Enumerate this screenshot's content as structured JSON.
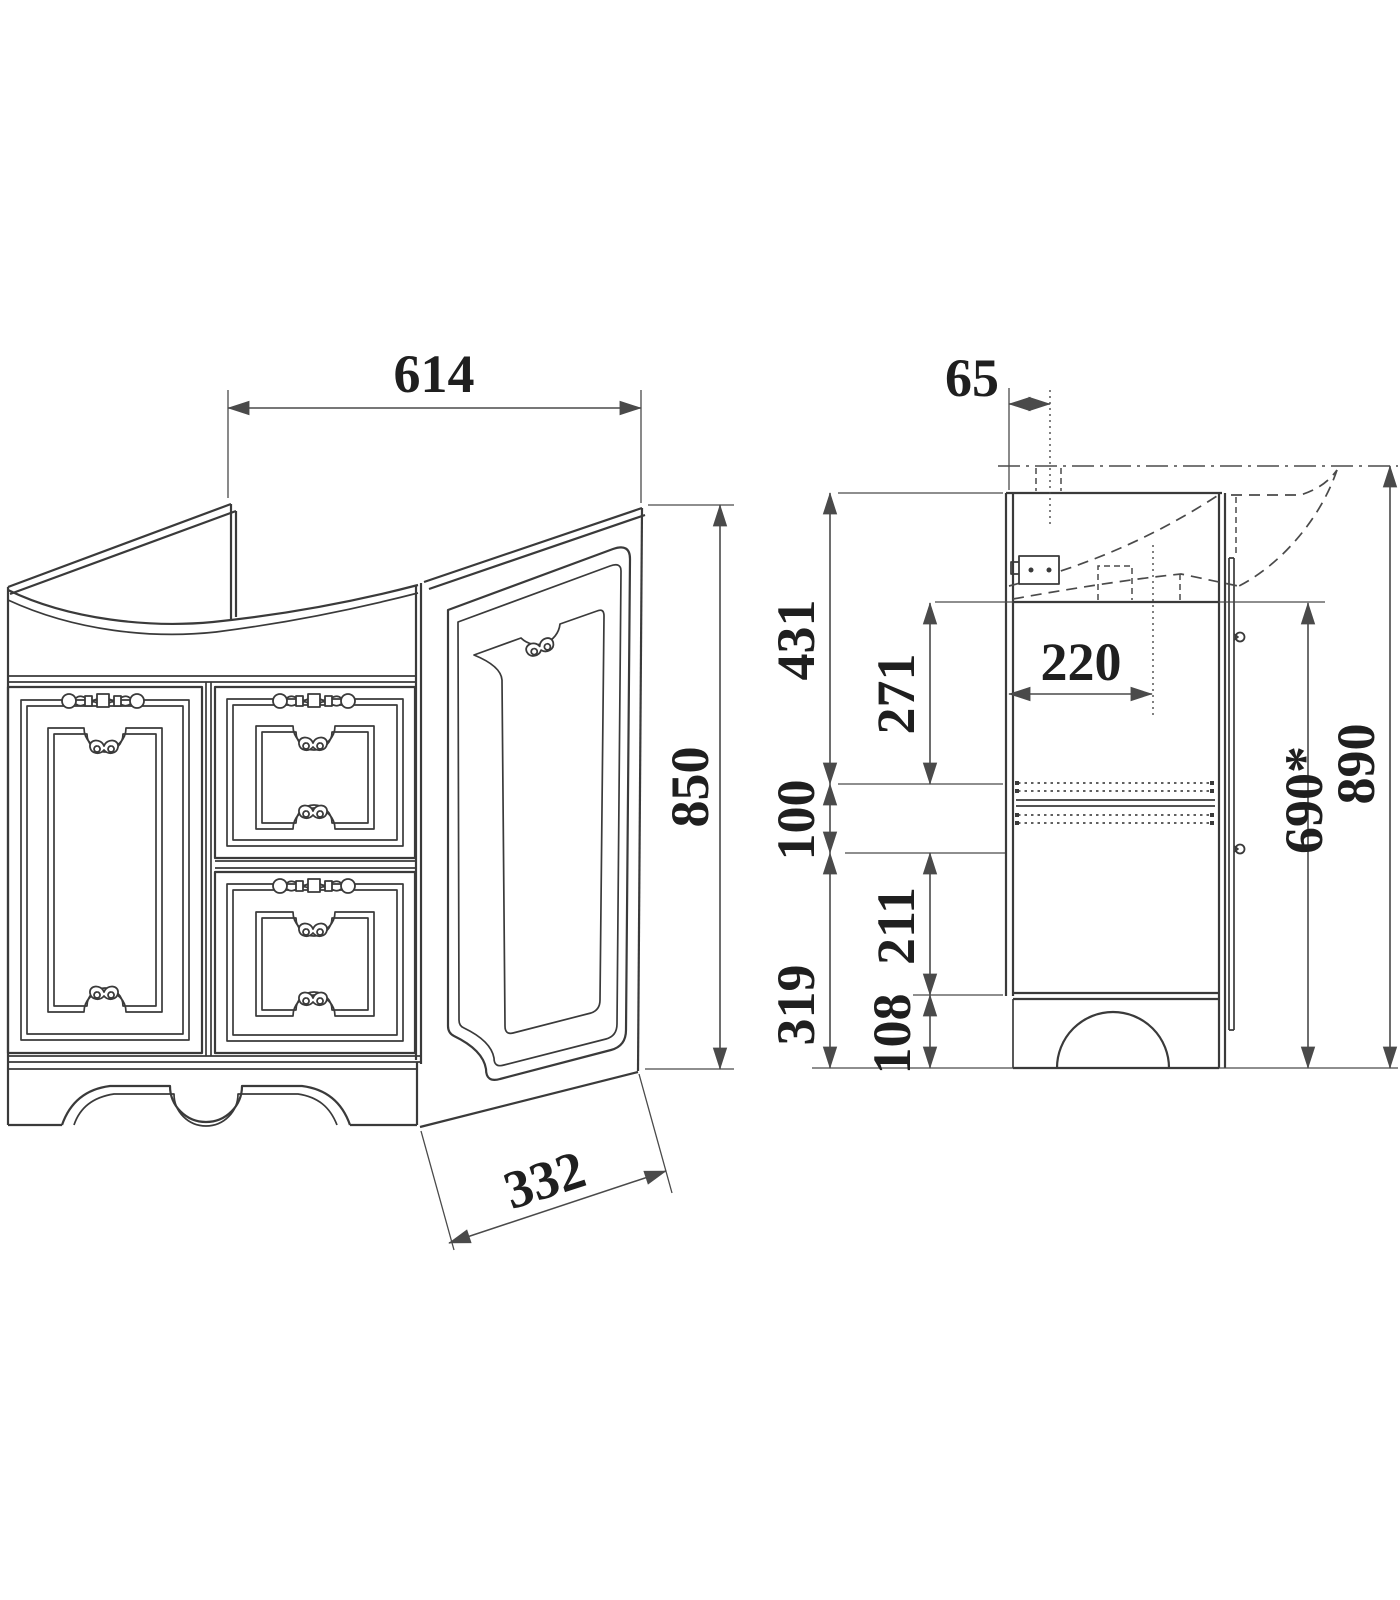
{
  "units": "mm",
  "colors": {
    "line": "#3a3a3a",
    "dimension_line": "#4a4a4a",
    "text": "#1f1f1f",
    "background": "#ffffff"
  },
  "front_view": {
    "width_top": "614",
    "height": "850",
    "side_panel_depth": "332"
  },
  "side_view": {
    "back_offset_top": "65",
    "top_to_drawer_slides": "431",
    "basin_bottom_to_drawer_slides": "271",
    "drain_axis_from_back": "220",
    "drawer_slide_zone": "100",
    "drawer_slides_to_floor": "319",
    "drawer_compartment": "211",
    "plinth_height": "108",
    "front_opening_height": "690*",
    "overall_height": "890"
  }
}
